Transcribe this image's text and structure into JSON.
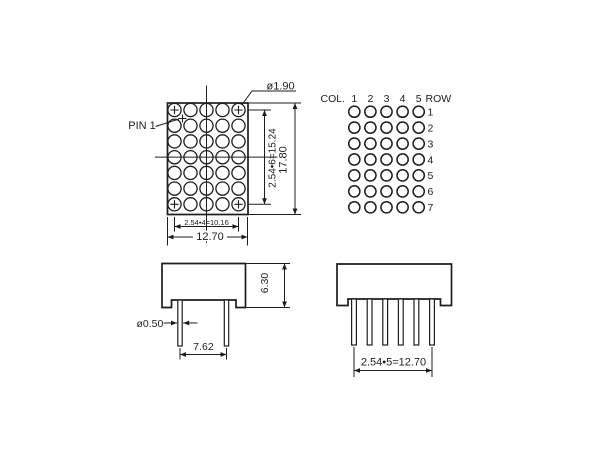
{
  "drawing": {
    "front_view": {
      "pin1_label": "PIN 1",
      "dot_dia": "ø1.90",
      "dim_row_span": "2.54•6=15.24",
      "dim_height": "17.80",
      "dim_col_span": "2.54•4=10.16",
      "dim_width": "12.70",
      "cols": 5,
      "rows": 7
    },
    "matrix_map": {
      "col_label": "COL.",
      "col_numbers": [
        "1",
        "2",
        "3",
        "4",
        "5"
      ],
      "row_label": "ROW",
      "row_numbers": [
        "1",
        "2",
        "3",
        "4",
        "5",
        "6",
        "7"
      ]
    },
    "side_view": {
      "dim_body_height": "6.30",
      "pin_dia": "ø0.50",
      "dim_pin_spacing": "7.62",
      "pin_count": 2
    },
    "pin_row_view": {
      "dim_pin_row": "2.54•5=12.70",
      "pin_count": 6
    },
    "colors": {
      "line": "#1d1d1d",
      "background": "#ffffff"
    }
  }
}
